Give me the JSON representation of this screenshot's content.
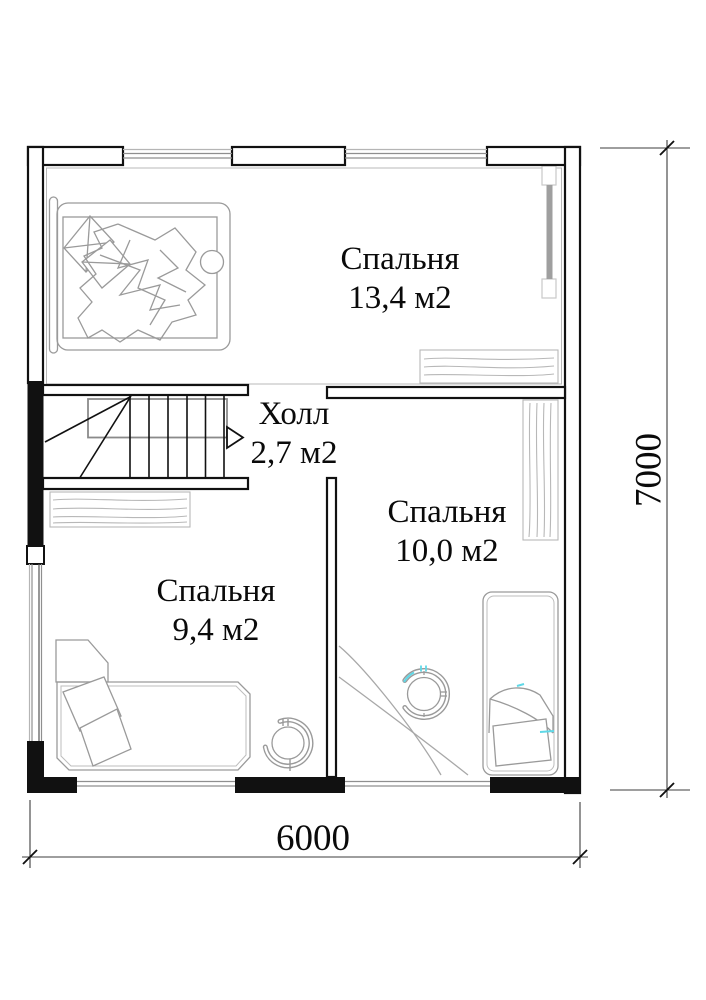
{
  "plan": {
    "rooms": [
      {
        "name": "Спальня",
        "area": "13,4 м2"
      },
      {
        "name": "Холл",
        "area": "2,7 м2"
      },
      {
        "name": "Спальня",
        "area": "10,0 м2"
      },
      {
        "name": "Спальня",
        "area": "9,4 м2"
      }
    ],
    "dimensions": {
      "width": "6000",
      "height": "7000"
    },
    "furniture": [
      {
        "name": "double-bed",
        "location": "top bedroom"
      },
      {
        "name": "dresser",
        "location": "top bedroom"
      },
      {
        "name": "radiator",
        "location": "top bedroom right wall"
      },
      {
        "name": "staircase-up",
        "location": "hall"
      },
      {
        "name": "shelf",
        "location": "left bedroom"
      },
      {
        "name": "single-bed",
        "location": "left bedroom"
      },
      {
        "name": "round-chair",
        "location": "left bedroom"
      },
      {
        "name": "wardrobe",
        "location": "right bedroom"
      },
      {
        "name": "corner-desk",
        "location": "right bedroom"
      },
      {
        "name": "office-chair",
        "location": "right bedroom"
      },
      {
        "name": "single-bed",
        "location": "right bedroom"
      }
    ],
    "colors": {
      "walls": "#111111",
      "furniture_line": "#9a9a9a",
      "wood_line": "#b8b8b8",
      "accent_cyan": "#5fd8e7",
      "background": "#ffffff"
    }
  }
}
